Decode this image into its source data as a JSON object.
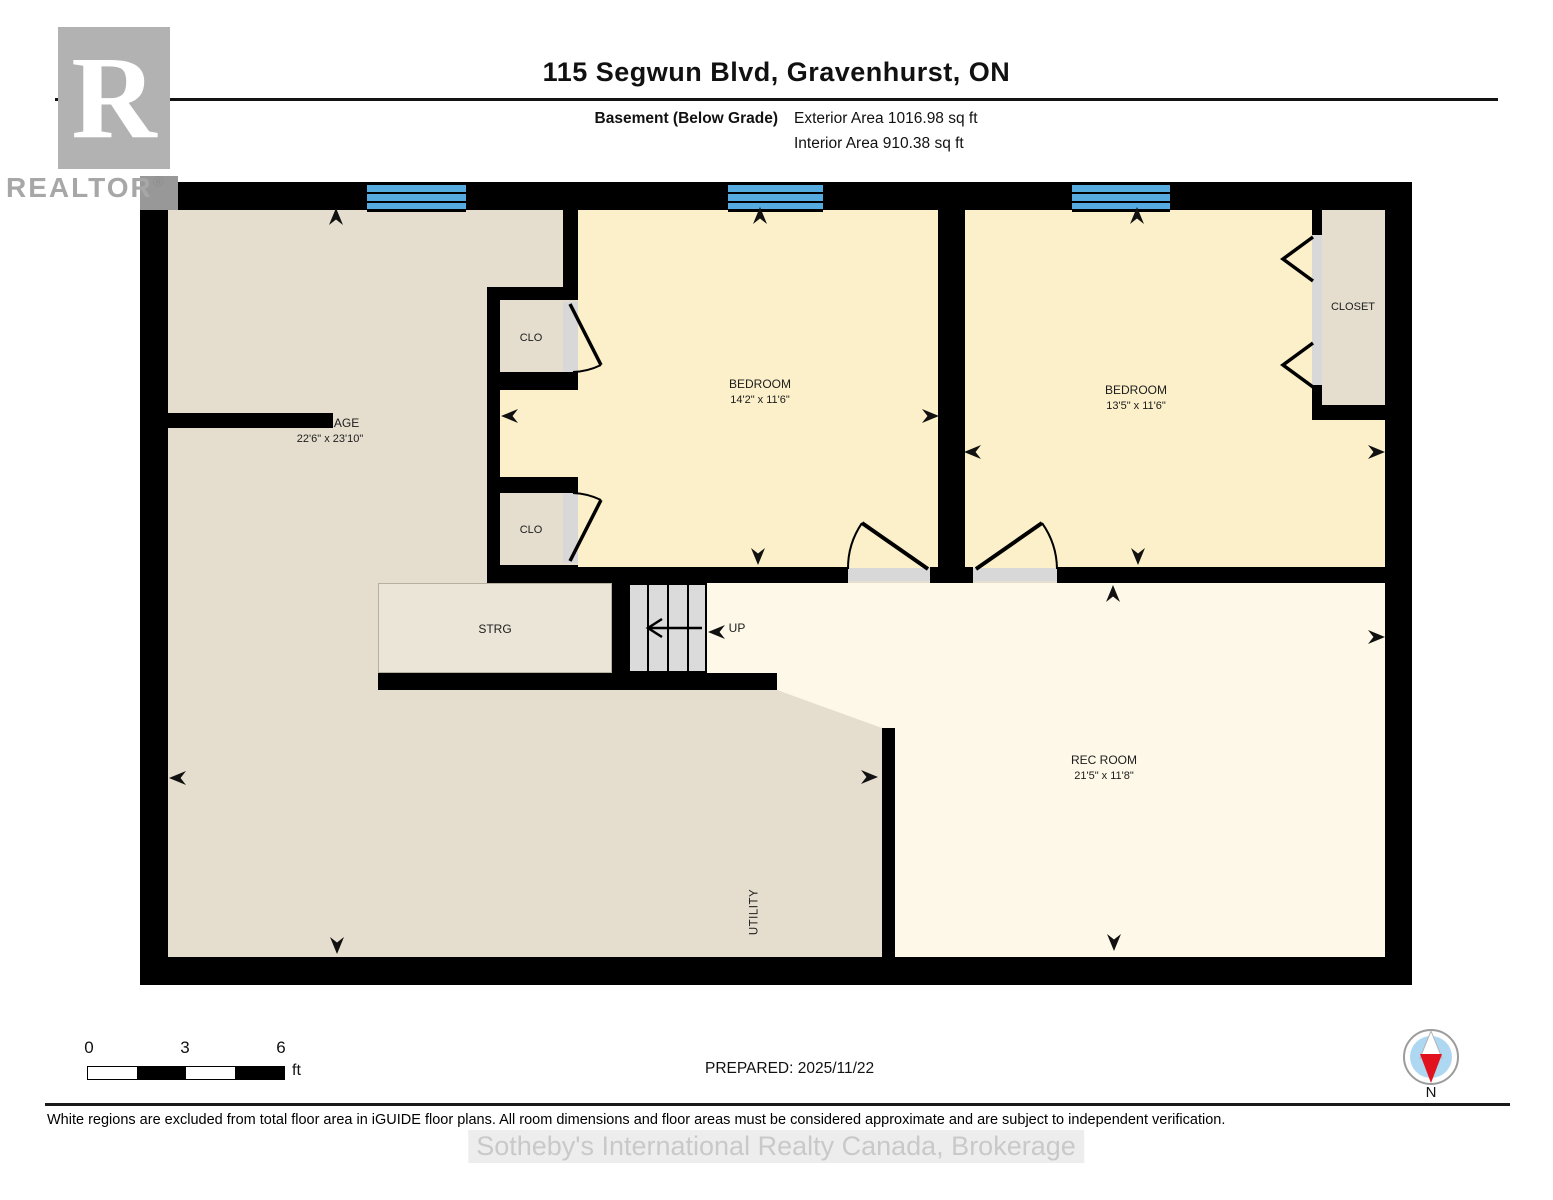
{
  "header": {
    "title": "115 Segwun Blvd, Gravenhurst, ON",
    "floor_label": "Basement (Below Grade)",
    "exterior_area": "Exterior Area 1016.98 sq ft",
    "interior_area": "Interior Area 910.38 sq ft"
  },
  "logo": {
    "letter": "R",
    "brand": "REALTOR",
    "registered": "®"
  },
  "rooms": {
    "storage": {
      "name": "STORAGE",
      "dims": "22'6\" x 23'10\""
    },
    "bedroom1": {
      "name": "BEDROOM",
      "dims": "14'2\" x 11'6\""
    },
    "bedroom2": {
      "name": "BEDROOM",
      "dims": "13'5\" x 11'6\""
    },
    "closet": {
      "name": "CLOSET"
    },
    "clo1": {
      "name": "CLO"
    },
    "clo2": {
      "name": "CLO"
    },
    "strg": {
      "name": "STRG"
    },
    "stairs": {
      "name": "UP"
    },
    "rec_room": {
      "name": "REC ROOM",
      "dims": "21'5\" x 11'8\""
    },
    "utility": {
      "name": "UTILITY"
    }
  },
  "scale_bar": {
    "ticks": [
      "0",
      "3",
      "6"
    ],
    "unit": "ft"
  },
  "prepared": "PREPARED: 2025/11/22",
  "compass": {
    "north_label": "N"
  },
  "footer": {
    "disclaimer": "White regions are excluded from total floor area in iGUIDE floor plans. All room dimensions and floor areas must be considered approximate and are subject to independent verification."
  },
  "watermark": "Sotheby's International Realty Canada, Brokerage",
  "colors": {
    "wall": "#000000",
    "storage_fill": "#e5decf",
    "bedroom_fill": "#fbf0ca",
    "rec_fill": "#fdf8e7",
    "window_blue": "#55abdf",
    "door_sill": "#d8d8d8",
    "compass_red": "#e1111e"
  }
}
